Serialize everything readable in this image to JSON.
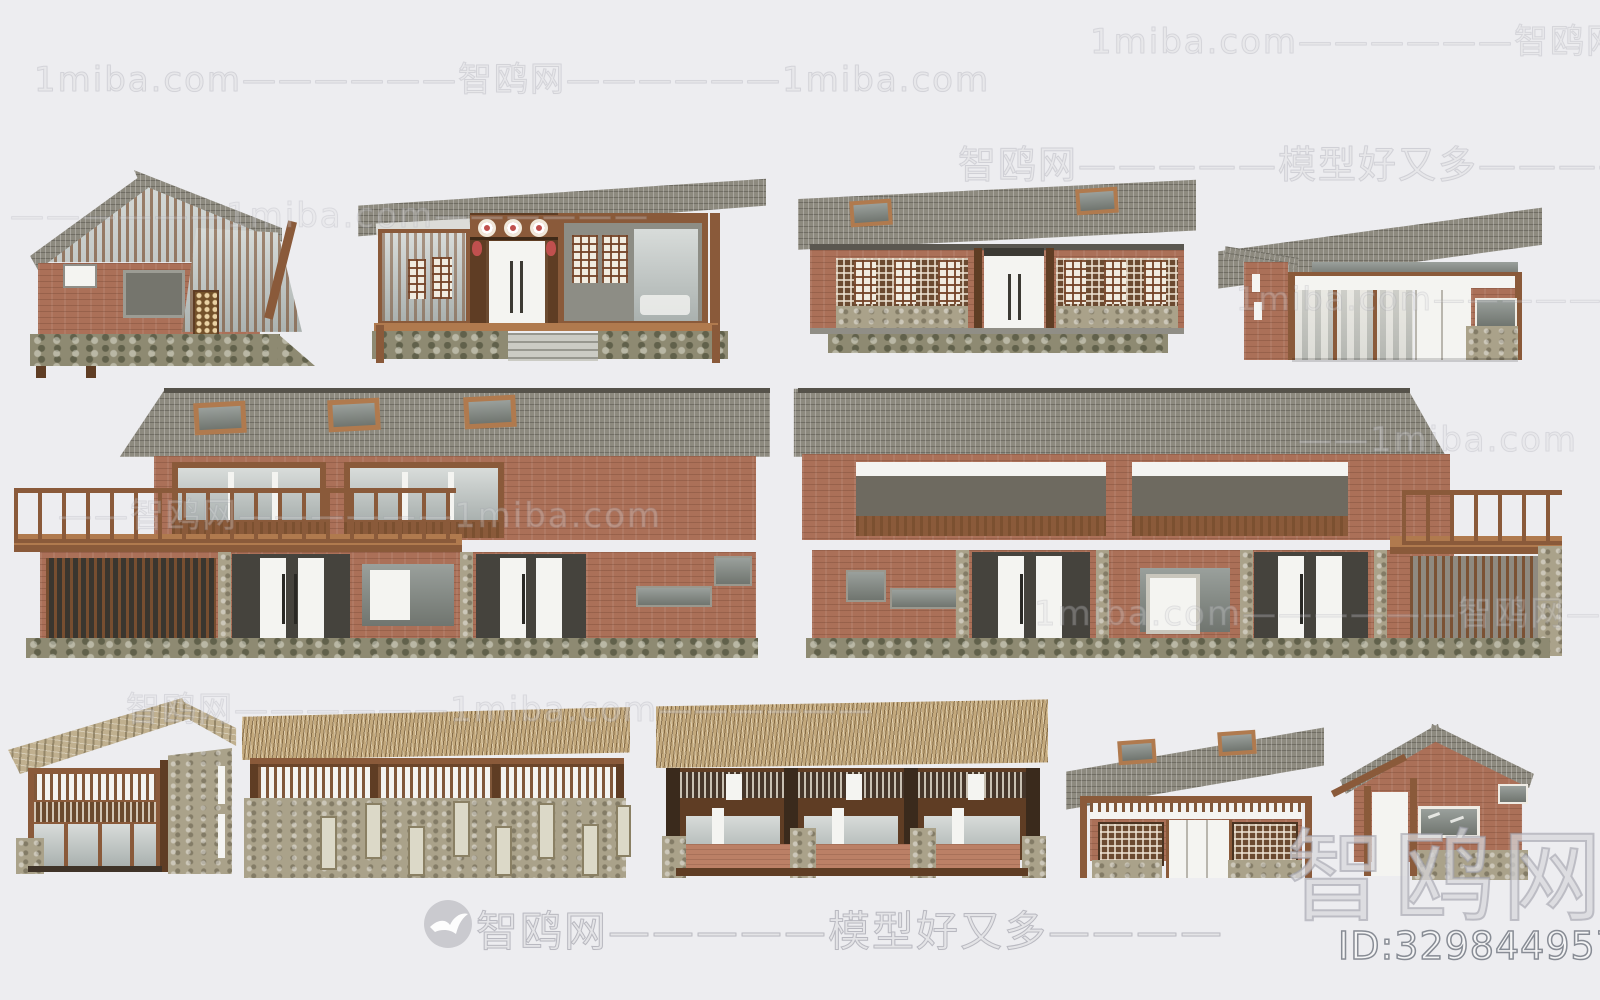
{
  "palette": {
    "bg": "#EDEDF0",
    "roof": "#8D8A7F",
    "slate": "#C0B08F",
    "thatch": "#C3A97D",
    "brick": "#AB7058",
    "stone": "#AAA28A",
    "stonef": "#8E8A72",
    "wood": "#8A5A3A",
    "woodd": "#5F3D24",
    "woodl": "#B07A4E",
    "white": "#F4F4F1",
    "red": "#C0504E",
    "watermark_stroke": "#9A9AA4"
  },
  "watermarks": {
    "brand_cn": "智鸥网",
    "brand_en": "1miba.com",
    "slogan": "模型好又多",
    "model_id": "ID:329844957",
    "big_watermark": "智鸥网",
    "lines": [
      {
        "id": "wm1",
        "text": "1miba.com——————智鸥网——————1miba.com"
      },
      {
        "id": "wm2",
        "text": "1miba.com——————智鸥网——————"
      },
      {
        "id": "wm3",
        "text": "智鸥网—————模型好又多————"
      },
      {
        "id": "wm4",
        "text": "——————1miba.com——————"
      },
      {
        "id": "wm5",
        "text": "1miba.com——————智鸥网"
      },
      {
        "id": "wm6",
        "text": "——智鸥网——————1miba.com"
      },
      {
        "id": "wm7",
        "text": "——1miba.com"
      },
      {
        "id": "wm8",
        "text": "1miba.com——————智鸥网————"
      },
      {
        "id": "wm9",
        "text": "智鸥网——————1miba.com——————"
      },
      {
        "id": "wm10",
        "text": "智鸥网—————模型好又多————"
      }
    ]
  }
}
